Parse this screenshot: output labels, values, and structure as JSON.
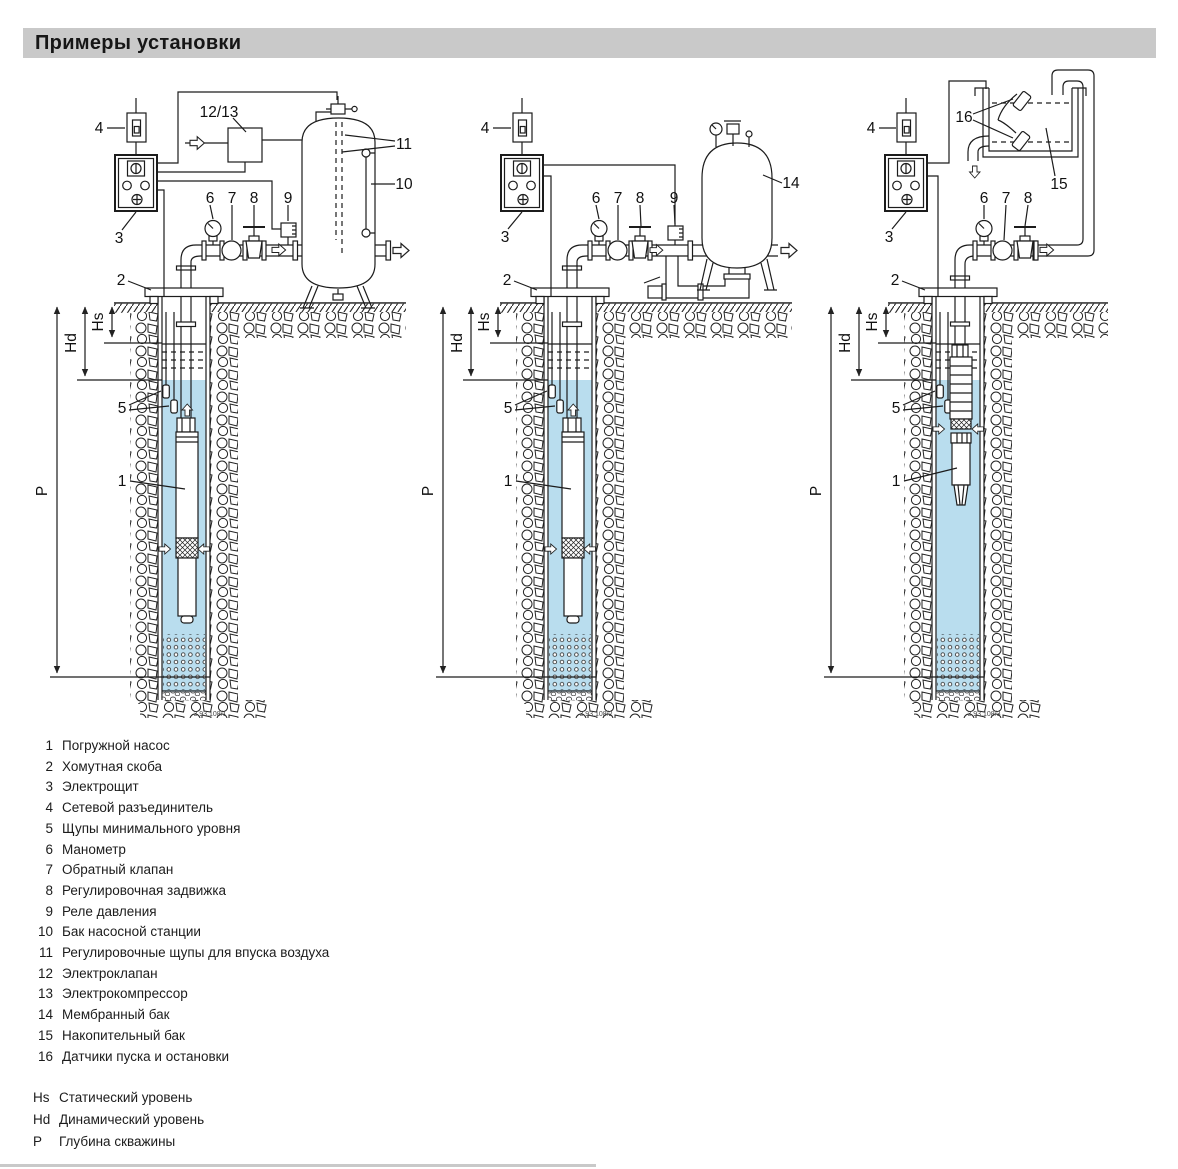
{
  "title": "Примеры установки",
  "colors": {
    "water": "#b9ddee",
    "bar": "#c9c9c9",
    "line": "#1c1c1c"
  },
  "labels": {
    "n1": "1",
    "n2": "2",
    "n3": "3",
    "n4": "4",
    "n5": "5",
    "n6": "6",
    "n7": "7",
    "n8": "8",
    "n9": "9",
    "n10": "10",
    "n11": "11",
    "n1213": "12/13",
    "n14": "14",
    "n15": "15",
    "n16": "16",
    "hs": "Hs",
    "hd": "Hd",
    "p": "P"
  },
  "diagrams": [
    {
      "caption": "3.93.108/1"
    },
    {
      "caption": "3.93.108/2"
    },
    {
      "caption": "3.93.108/3"
    }
  ],
  "legend": {
    "items": [
      {
        "num": "1",
        "text": "Погружной насос"
      },
      {
        "num": "2",
        "text": "Хомутная скоба"
      },
      {
        "num": "3",
        "text": "Электрощит"
      },
      {
        "num": "4",
        "text": "Сетевой разъединитель"
      },
      {
        "num": "5",
        "text": "Щупы минимального уровня"
      },
      {
        "num": "6",
        "text": "Манометр"
      },
      {
        "num": "7",
        "text": "Обратный клапан"
      },
      {
        "num": "8",
        "text": "Регулировочная задвижка"
      },
      {
        "num": "9",
        "text": "Реле давления"
      },
      {
        "num": "10",
        "text": "Бак насосной станции"
      },
      {
        "num": "11",
        "text": "Регулировочные щупы для впуска воздуха"
      },
      {
        "num": "12",
        "text": "Электроклапан"
      },
      {
        "num": "13",
        "text": "Электрокомпрессор"
      },
      {
        "num": "14",
        "text": "Мембранный бак"
      },
      {
        "num": "15",
        "text": "Накопительный бак"
      },
      {
        "num": "16",
        "text": "Датчики пуска и остановки"
      }
    ]
  },
  "levels": [
    {
      "sym": "Hs",
      "text": "Статический уровень"
    },
    {
      "sym": "Hd",
      "text": "Динамический уровень"
    },
    {
      "sym": "P",
      "text": "Глубина скважины"
    }
  ]
}
